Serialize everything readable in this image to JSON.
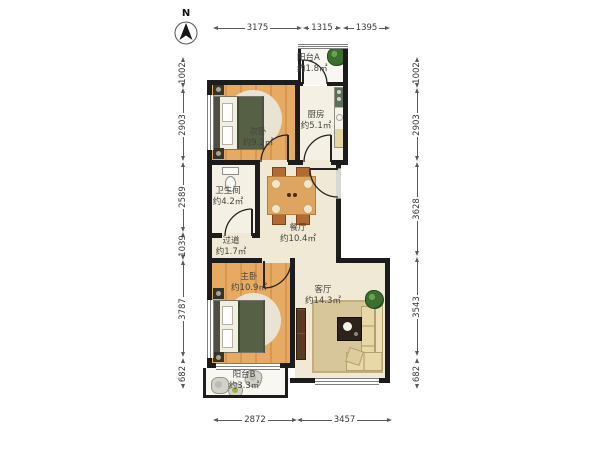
{
  "compass": {
    "label": "N"
  },
  "dimensions": {
    "top": [
      "3175",
      "1315",
      "1395"
    ],
    "left": [
      "1002",
      "2903",
      "2589",
      "1039",
      "3787",
      "682"
    ],
    "right": [
      "1002",
      "2903",
      "3628",
      "3543",
      "682"
    ],
    "bottom": [
      "2872",
      "3457"
    ]
  },
  "rooms": [
    {
      "name": "次卧",
      "area": "约9.2㎡"
    },
    {
      "name": "厨房",
      "area": "约5.1㎡"
    },
    {
      "name": "阳台A",
      "area": "约1.8㎡"
    },
    {
      "name": "卫生间",
      "area": "约4.2㎡"
    },
    {
      "name": "过道",
      "area": "约1.7㎡"
    },
    {
      "name": "餐厅",
      "area": "约10.4㎡"
    },
    {
      "name": "主卧",
      "area": "约10.9㎡"
    },
    {
      "name": "客厅",
      "area": "约14.3㎡"
    },
    {
      "name": "阳台B",
      "area": "约3.3㎡"
    }
  ],
  "colors": {
    "wall": "#1c1c1c",
    "wood_floor": "#e7aa62",
    "tile_floor": "#f0e9d6",
    "plant_green": "#3c6e2e",
    "blanket_green": "#566044",
    "dim_line": "#5a5a5a"
  }
}
